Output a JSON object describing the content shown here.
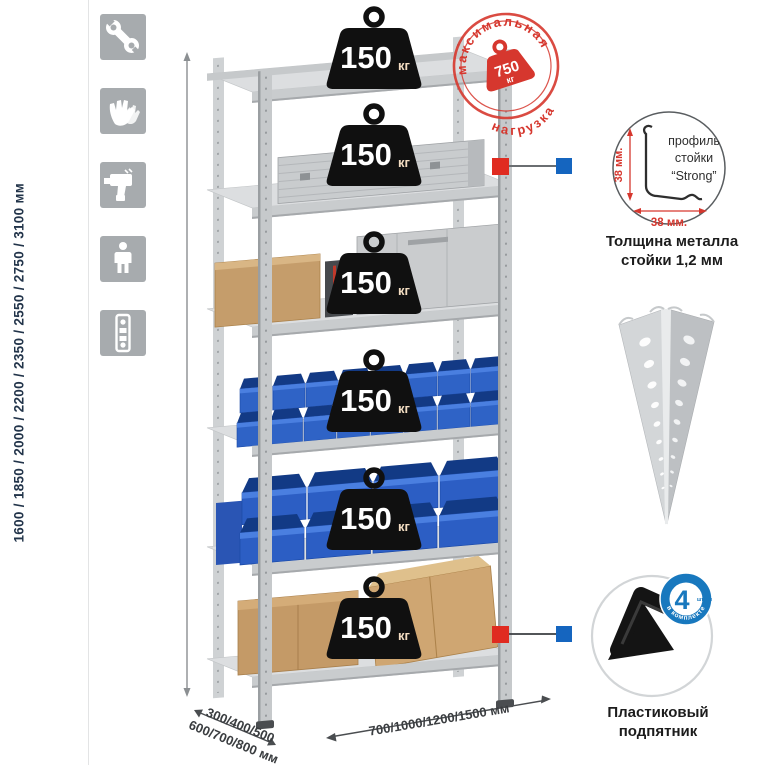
{
  "sidebar_icons": [
    {
      "name": "wrench"
    },
    {
      "name": "gloves"
    },
    {
      "name": "drill"
    },
    {
      "name": "person"
    },
    {
      "name": "profile-strip"
    }
  ],
  "dimensions": {
    "height": "1600 / 1850 / 2000 / 2200 / 2350 / 2550 / 2750 / 3100 мм",
    "depth_line1": "300/400/500",
    "depth_line2": "600/700/800 мм",
    "width": "700/1000/1200/1500 мм"
  },
  "stamp": {
    "arc_top": "максимальная",
    "arc_bottom": "нагрузка",
    "value": "750",
    "unit": "кг"
  },
  "shelf_load": {
    "value": "150",
    "unit": "кг",
    "count": 6
  },
  "profile_detail": {
    "label_line1": "профиль",
    "label_line2": "стойки",
    "label_line3": "“Strong”",
    "dim_vertical": "38 мм.",
    "dim_horizontal": "38 мм.",
    "caption_line1": "Толщина металла",
    "caption_line2": "стойки 1,2 мм"
  },
  "foot_detail": {
    "badge_number": "4",
    "badge_small": "штуки",
    "badge_arc": "в комплекте",
    "caption_line1": "Пластиковый",
    "caption_line2": "подпятник"
  },
  "colors": {
    "accent_red": "#d6372e",
    "marker_red": "#e02b20",
    "marker_blue": "#1565bf",
    "badge_blue": "#1878be",
    "bin_blue": "#2f63c6",
    "metal_gray": "#c9ccce",
    "icon_gray": "#a7abae",
    "cardboard": "#c49a67"
  }
}
